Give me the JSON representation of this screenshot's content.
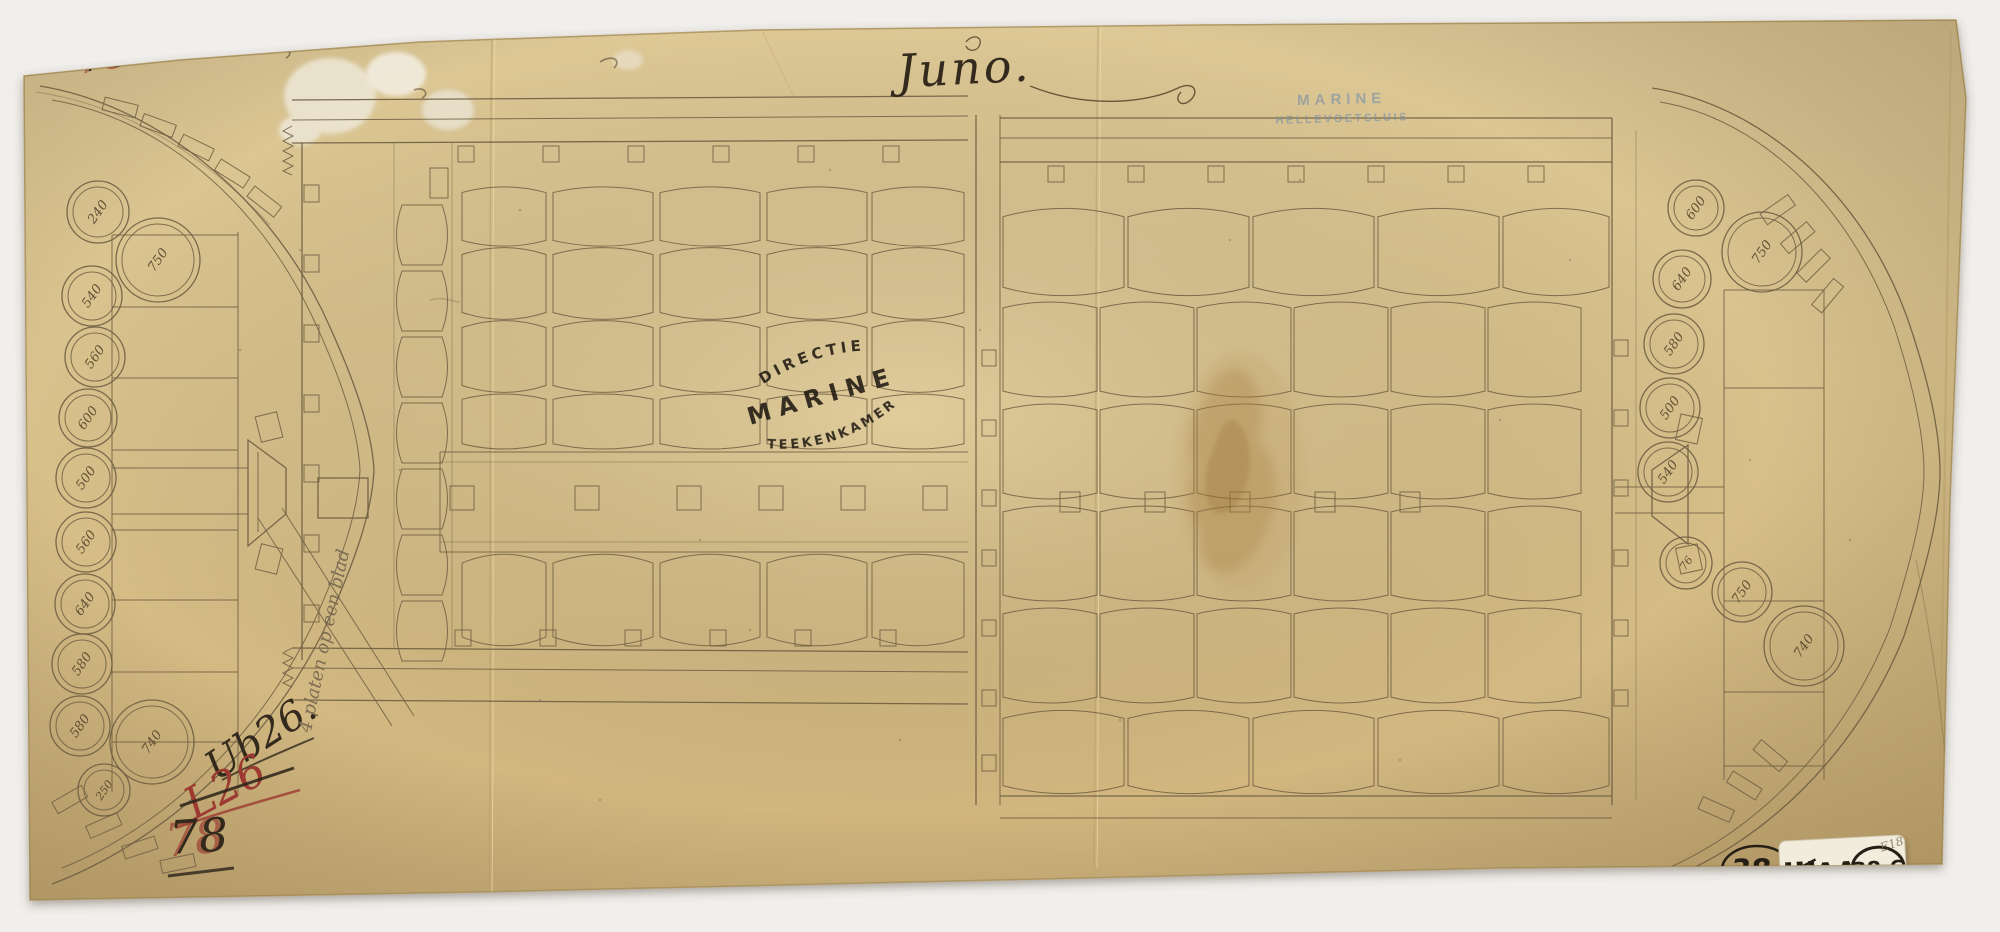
{
  "document": {
    "title": "Juno.",
    "stamps": {
      "top_right": {
        "line1": "MARINE",
        "line2": "HELLEVOETSLUIS"
      },
      "center_oval": {
        "arc_top": "DIRECTIE",
        "center": "MARINE",
        "arc_bottom": "TEEKENKAMER"
      }
    },
    "annotations": {
      "top_left_mark": "78",
      "inventory_number_black": "Ub26.",
      "inventory_number_red": "L26",
      "diagonal_note": "4 platen op een blad",
      "bottom_left_mark": "78",
      "pencil_note": "E18"
    },
    "catalog": {
      "paper_number": "38.",
      "sticker_roman": "III",
      "sticker_letters": "AA",
      "sticker_circled": "38.6"
    }
  },
  "plan": {
    "bow_casks": [
      {
        "x": 98,
        "y": 212,
        "r": 31,
        "label": "240"
      },
      {
        "x": 158,
        "y": 260,
        "r": 42,
        "label": "750"
      },
      {
        "x": 92,
        "y": 296,
        "r": 30,
        "label": "540"
      },
      {
        "x": 95,
        "y": 357,
        "r": 30,
        "label": "560"
      },
      {
        "x": 88,
        "y": 418,
        "r": 29,
        "label": "600"
      },
      {
        "x": 86,
        "y": 478,
        "r": 30,
        "label": "500"
      },
      {
        "x": 86,
        "y": 542,
        "r": 30,
        "label": "560"
      },
      {
        "x": 85,
        "y": 604,
        "r": 30,
        "label": "640"
      },
      {
        "x": 82,
        "y": 664,
        "r": 30,
        "label": "580"
      },
      {
        "x": 80,
        "y": 726,
        "r": 30,
        "label": "580"
      },
      {
        "x": 152,
        "y": 742,
        "r": 42,
        "label": "740"
      },
      {
        "x": 104,
        "y": 790,
        "r": 26,
        "label": "250"
      }
    ],
    "stern_casks": [
      {
        "x": 1696,
        "y": 208,
        "r": 28,
        "label": "600"
      },
      {
        "x": 1762,
        "y": 252,
        "r": 40,
        "label": "750"
      },
      {
        "x": 1682,
        "y": 279,
        "r": 29,
        "label": "640"
      },
      {
        "x": 1674,
        "y": 344,
        "r": 30,
        "label": "580"
      },
      {
        "x": 1670,
        "y": 408,
        "r": 30,
        "label": "500"
      },
      {
        "x": 1668,
        "y": 472,
        "r": 30,
        "label": "540"
      },
      {
        "x": 1686,
        "y": 563,
        "r": 26,
        "label": "76"
      },
      {
        "x": 1742,
        "y": 592,
        "r": 30,
        "label": "750"
      },
      {
        "x": 1804,
        "y": 646,
        "r": 40,
        "label": "740"
      }
    ]
  },
  "colors": {
    "paper": "#d8c18c",
    "ink": "#6e5e42",
    "hand_ink": "#332a1d",
    "red_ink": "#9c3a31",
    "stamp_blue": "#8494a6",
    "stamp_black": "#1f1a12"
  }
}
